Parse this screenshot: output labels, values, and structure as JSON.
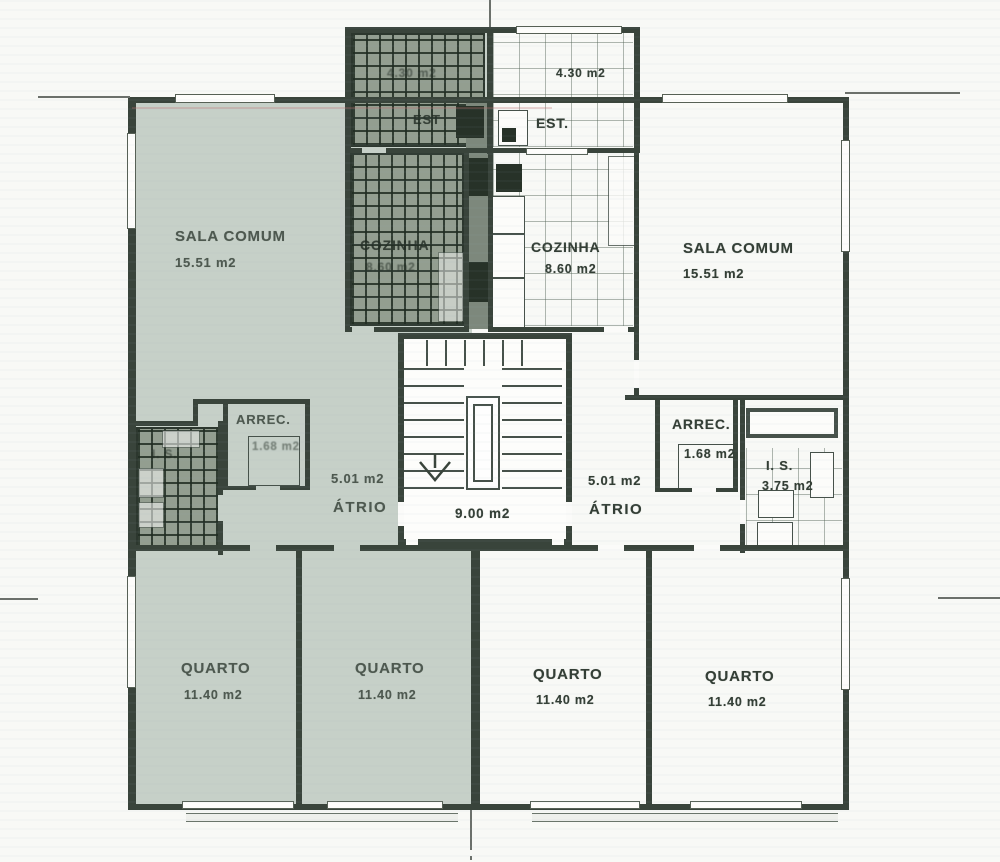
{
  "plan": {
    "stairwell": {
      "area": "9.00 m2"
    },
    "apartments": {
      "left": {
        "est": {
          "label": "EST",
          "area": "4.30 m2"
        },
        "cozinha": {
          "label": "COZINHA",
          "area": "8.60 m2"
        },
        "sala": {
          "label": "SALA COMUM",
          "area": "15.51 m2"
        },
        "arrec": {
          "label": "ARREC.",
          "area": "1.68 m2"
        },
        "is": {
          "label": "I. S."
        },
        "atrio": {
          "label": "ÁTRIO",
          "area": "5.01 m2"
        },
        "quarto_a": {
          "label": "QUARTO",
          "area": "11.40 m2"
        },
        "quarto_b": {
          "label": "QUARTO",
          "area": "11.40 m2"
        }
      },
      "right": {
        "est": {
          "label": "EST.",
          "area": "4.30 m2"
        },
        "cozinha": {
          "label": "COZINHA",
          "area": "8.60 m2"
        },
        "sala": {
          "label": "SALA COMUM",
          "area": "15.51 m2"
        },
        "arrec": {
          "label": "ARREC.",
          "area": "1.68 m2"
        },
        "is": {
          "label": "I. S.",
          "area": "3.75 m2"
        },
        "atrio": {
          "label": "ÁTRIO",
          "area": "5.01 m2"
        },
        "quarto_a": {
          "label": "QUARTO",
          "area": "11.40 m2"
        },
        "quarto_b": {
          "label": "QUARTO",
          "area": "11.40 m2"
        }
      }
    },
    "colors": {
      "highlight": "#c6d0c8",
      "ink": "#39443b",
      "paper": "#f8f9f6"
    }
  }
}
